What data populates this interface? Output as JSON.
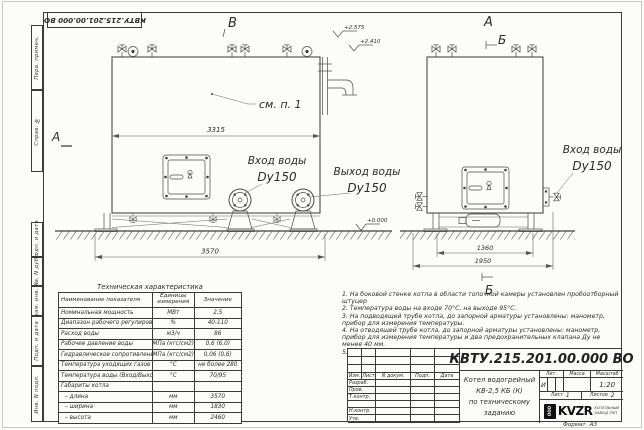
{
  "frame": {
    "margin_labels": [
      "Перв. примен.",
      "Справ. №",
      "Подп. и дата",
      "Инв. N дубл.",
      "Взам. инв. N",
      "Подп. и дата",
      "Инв. N подл."
    ],
    "top_designation": "КВТУ.215.201.00.000 ВО",
    "format_label": "Формат",
    "format_value": "А3"
  },
  "drawing": {
    "markers": {
      "view_b": "В",
      "section_a_left": "А",
      "view_a_right": "А",
      "section_b_top": "Б",
      "section_b_bottom": "Б"
    },
    "labels": {
      "see_item": "см. п. 1",
      "inlet_title": "Вход воды",
      "inlet_dn": "Dy150",
      "outlet_title": "Выход воды",
      "outlet_dn": "Dy150",
      "side_inlet_title": "Вход воды",
      "side_inlet_dn": "Dy150"
    },
    "elevations": {
      "top": "+2.575",
      "mid": "+2.410",
      "ground": "+0.000"
    },
    "dimensions": {
      "boiler_length": "3315",
      "base_length": "3570",
      "frame_width": "1360",
      "overall_width": "1950"
    }
  },
  "tech_table": {
    "title": "Техническая характеристика",
    "headers": [
      "Наименование показателя",
      "Единицы измерения",
      "Значение"
    ],
    "rows": [
      [
        "Номинальная мощность",
        "МВт",
        "2,5"
      ],
      [
        "Диапазон рабочего регулирования",
        "%",
        "40-110"
      ],
      [
        "Расход воды",
        "м3/ч",
        "86"
      ],
      [
        "Рабочее давление воды",
        "МПа (кгс/см2)",
        "0,6 (6,0)"
      ],
      [
        "Гидравлическое сопротивление котла",
        "МПа (кгс/см2)",
        "0,06 (0,6)"
      ],
      [
        "Температура уходящих газов",
        "°С",
        "не более 280"
      ],
      [
        "Температура воды (Вход/Выход)",
        "°С",
        "70/95"
      ],
      [
        "Габариты котла",
        "",
        ""
      ],
      [
        "– длина",
        "мм",
        "3570"
      ],
      [
        "– ширина",
        "мм",
        "1830"
      ],
      [
        "– высота",
        "мм",
        "2460"
      ]
    ]
  },
  "notes": {
    "items": [
      "1.  На боковой стенке котла в области топочной камеры установлен пробоотборный штуцер",
      "2.  Температура воды на входе 70°С, на выходе 95°С.",
      "3.  На подводящей трубе котла, до запорной арматуры установлены: манометр, прибор для измерения температуры.",
      "4.  На отводящей трубе котла, до запорной арматуры установлены: манометр, прибор для измерения температуры и два предохранительных клапана Ду не менее 40 мм.",
      "5.  Остальные технические требования по ОСТ 108.030.133-84."
    ]
  },
  "title_block": {
    "designation": "КВТУ.215.201.00.000 ВО",
    "product_line1": "Котел водогрейный",
    "product_line2": "КВ-2,5 КБ (К)",
    "product_line3": "по техническому заданию",
    "col_izm": "Изм.",
    "col_list": "Лист",
    "col_doc": "N докум.",
    "col_podp": "Подп.",
    "col_data": "Дата",
    "row_labels": [
      "Разраб.",
      "Пров.",
      "Т.контр.",
      "",
      "Н.контр.",
      "Утв."
    ],
    "lit_label": "Лит.",
    "mass_label": "Масса",
    "scale_label": "Масштаб",
    "lit_value": "И",
    "scale_value": "1:20",
    "sheet_label": "Лист",
    "sheet_number": "1",
    "sheets_label": "Листов",
    "sheets_total": "2",
    "company_logo": "KVZR",
    "company_icon": "ООО",
    "company_line1": "КОТЕЛЬНЫЙ",
    "company_line2": "ЗАВОД РЭП"
  }
}
